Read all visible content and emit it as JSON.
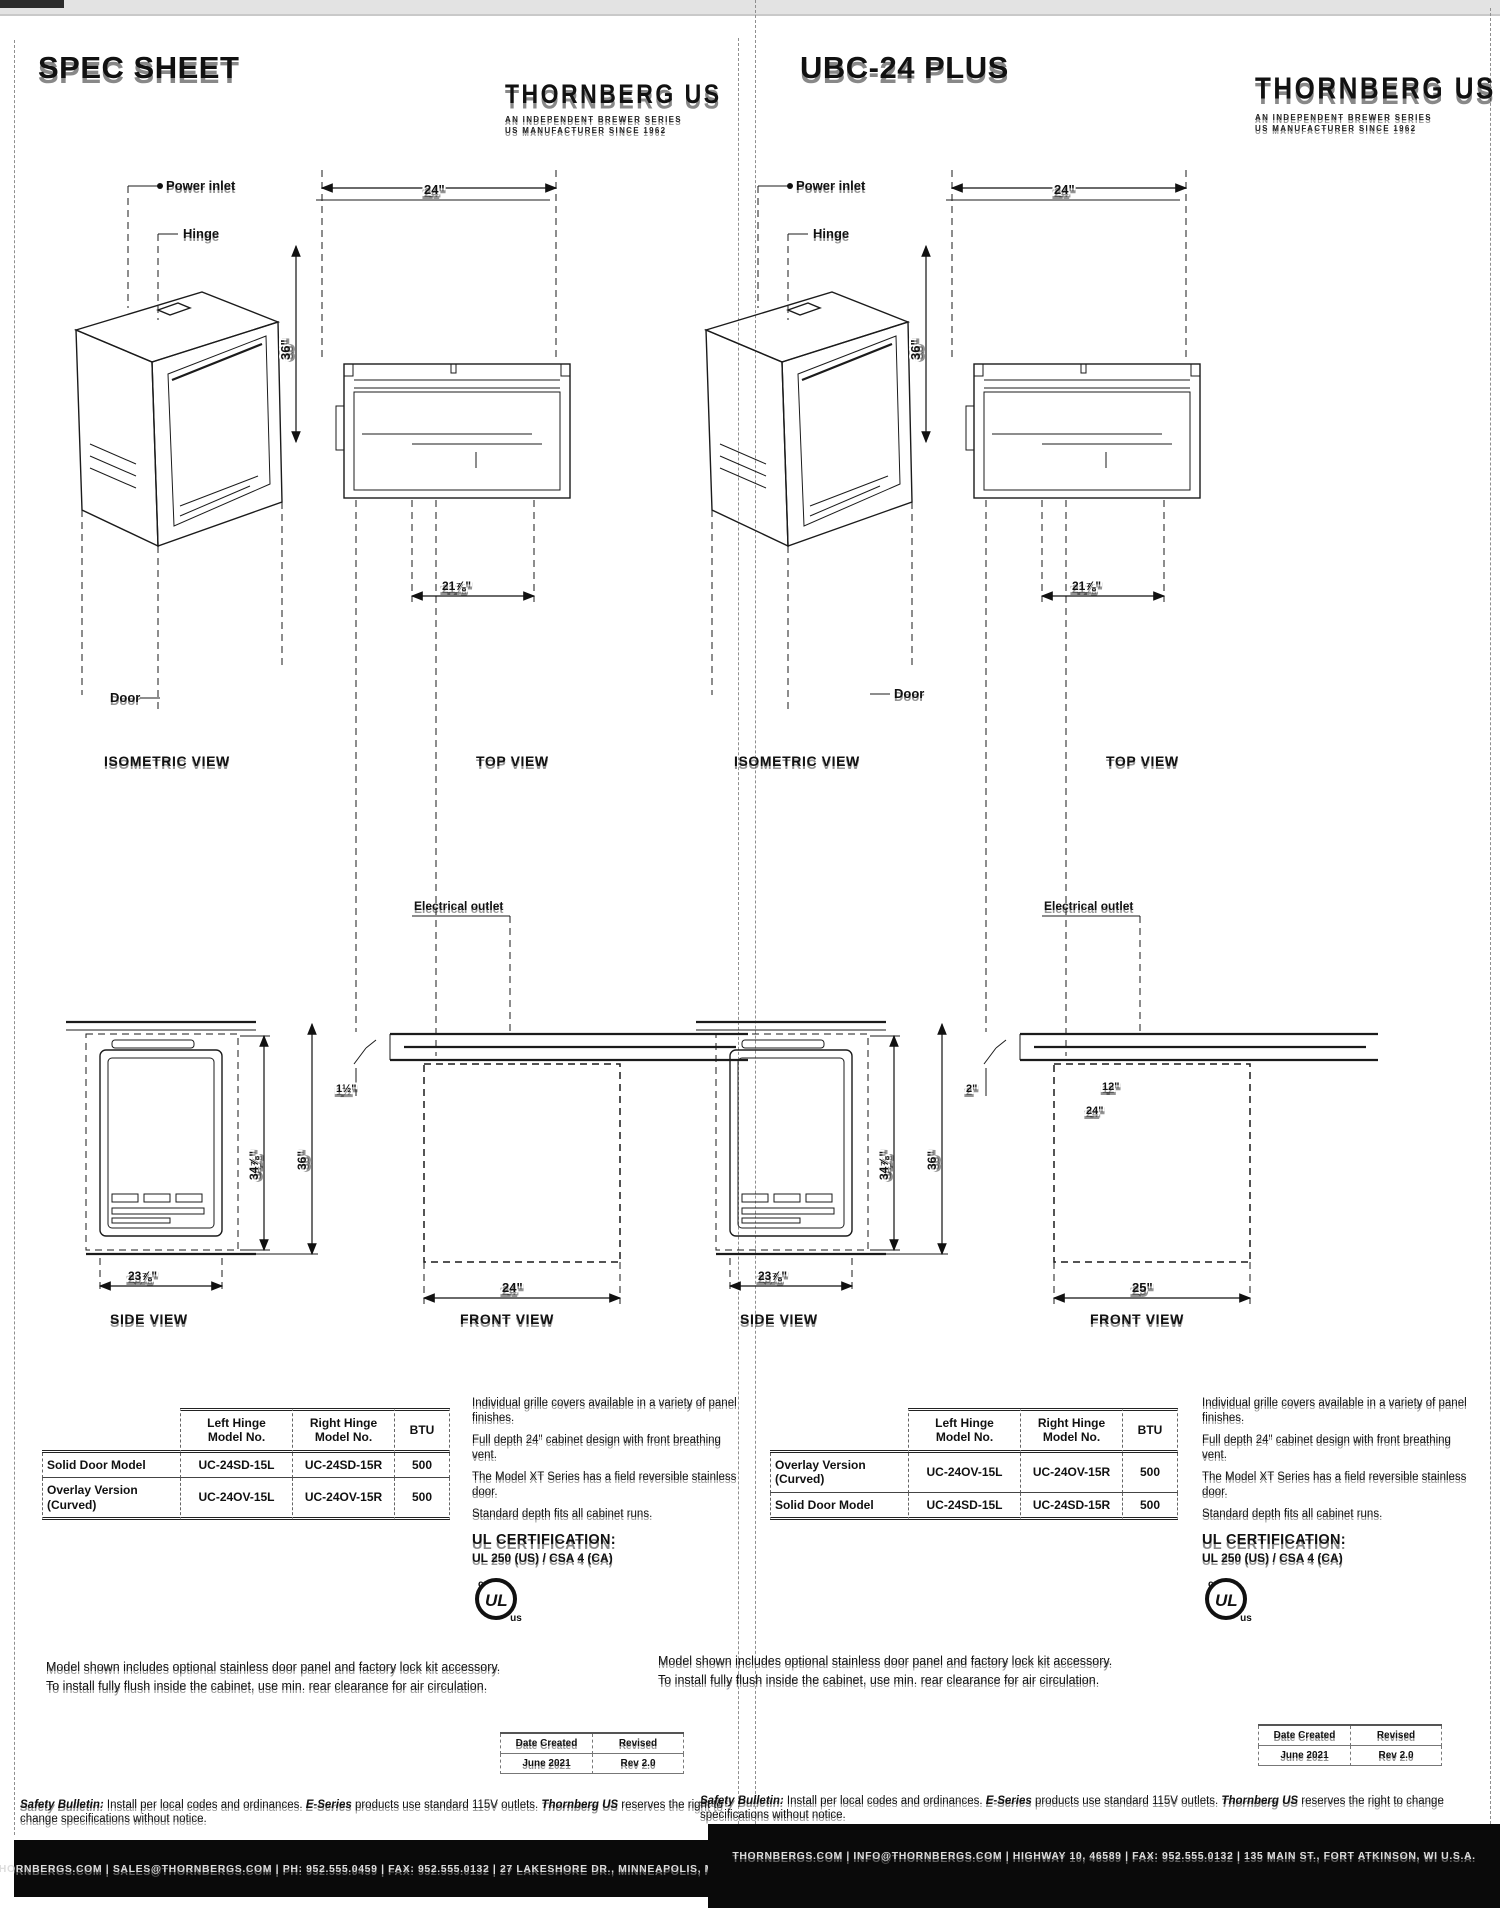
{
  "pages": [
    {
      "title": "SPEC SHEET",
      "logo": {
        "brand": "THORNBERG US",
        "tag1": "AN INDEPENDENT BREWER SERIES",
        "tag2": "US MANUFACTURER SINCE 1962"
      },
      "iso": {
        "cap": "ISOMETRIC VIEW",
        "l1": "Power inlet",
        "l2": "Hinge",
        "l3": "Door"
      },
      "top": {
        "cap": "TOP VIEW",
        "w": "24\"",
        "d": "36\"",
        "wb": "21⅞\""
      },
      "side": {
        "cap": "SIDE VIEW",
        "h1": "34⅞\"",
        "h2": "36\"",
        "w": "23⅞\""
      },
      "front": {
        "cap": "FRONT VIEW",
        "label": "Electrical outlet",
        "n1": "1½\"",
        "r1": "",
        "r2": "",
        "w": "24\""
      },
      "table": {
        "h1": "Left Hinge\nModel No.",
        "h2": "Right Hinge\nModel No.",
        "h3": "BTU",
        "rows": [
          {
            "label": "Solid Door Model",
            "l": "UC-24SD-15L",
            "r": "UC-24SD-15R",
            "btu": "500"
          },
          {
            "label": "Overlay Version (Curved)",
            "l": "UC-24OV-15L",
            "r": "UC-24OV-15R",
            "btu": "500"
          }
        ]
      },
      "notes": {
        "0": "Individual grille covers available in a variety of panel finishes.",
        "1": "Full depth 24\" cabinet design with front breathing vent.",
        "2": "The Model XT Series has a field reversible stainless door.",
        "3": "Standard depth fits all cabinet runs."
      },
      "cert_heading": "UL CERTIFICATION:",
      "cert_line": "UL 250 (US) / CSA 4 (CA)",
      "para1": "Model shown includes optional stainless door panel and factory lock kit accessory.",
      "para2": "To install fully flush inside the cabinet, use min. rear clearance for air circulation.",
      "rev": {
        "h1": "Date Created",
        "h2": "Revised",
        "v1": "June 2021",
        "v2": "Rev 2.0"
      },
      "safety": {
        "lead": "Safety Bulletin:",
        "text": " Install per local codes and ordinances. ",
        "em": "E-Series",
        "text2": " products use standard 115V outlets. ",
        "em2": "Thornberg US",
        "tail": " reserves the right to change specifications without notice."
      },
      "bar": "THORNBERGS.COM  |  SALES@THORNBERGS.COM  |  PH: 952.555.0459  |  FAX: 952.555.0132  |  27 LAKESHORE DR., MINNEAPOLIS, MN  U.S.A."
    },
    {
      "title": "UBC-24 PLUS",
      "logo": {
        "brand": "THORNBERG US",
        "tag1": "AN INDEPENDENT BREWER SERIES",
        "tag2": "US MANUFACTURER SINCE 1962"
      },
      "iso": {
        "cap": "ISOMETRIC VIEW",
        "l1": "Power inlet",
        "l2": "Hinge",
        "l3": "Door"
      },
      "top": {
        "cap": "TOP VIEW",
        "w": "24\"",
        "d": "36\"",
        "wb": "21⅞\""
      },
      "side": {
        "cap": "SIDE VIEW",
        "h1": "34⅞\"",
        "h2": "36\"",
        "w": "23⅞\""
      },
      "front": {
        "cap": "FRONT VIEW",
        "label": "Electrical outlet",
        "n1": "2\"",
        "r1": "12\"",
        "r2": "24\"",
        "w": "25\""
      },
      "table": {
        "h1": "Left Hinge\nModel No.",
        "h2": "Right Hinge\nModel No.",
        "h3": "BTU",
        "rows": [
          {
            "label": "Overlay Version (Curved)",
            "l": "UC-24OV-15L",
            "r": "UC-24OV-15R",
            "btu": "500"
          },
          {
            "label": "Solid Door Model",
            "l": "UC-24SD-15L",
            "r": "UC-24SD-15R",
            "btu": "500"
          }
        ]
      },
      "notes": {
        "0": "Individual grille covers available in a variety of panel finishes.",
        "1": "Full depth 24\" cabinet design with front breathing vent.",
        "2": "The Model XT Series has a field reversible stainless door.",
        "3": "Standard depth fits all cabinet runs."
      },
      "cert_heading": "UL CERTIFICATION:",
      "cert_line": "UL 250 (US) / CSA 4 (CA)",
      "para1": "Model shown includes optional stainless door panel and factory lock kit accessory.",
      "para2": "To install fully flush inside the cabinet, use min. rear clearance for air circulation.",
      "rev": {
        "h1": "Date Created",
        "h2": "Revised",
        "v1": "June 2021",
        "v2": "Rev 2.0"
      },
      "safety": {
        "lead": "Safety Bulletin:",
        "text": " Install per local codes and ordinances. ",
        "em": "E-Series",
        "text2": " products use standard 115V outlets. ",
        "em2": "Thornberg US",
        "tail": " reserves the right to change specifications without notice."
      },
      "bar": "THORNBERGS.COM  |  INFO@THORNBERGS.COM  |  HIGHWAY 10, 46589  |  FAX: 952.555.0132  |  135 MAIN ST., FORT ATKINSON, WI  U.S.A."
    }
  ]
}
